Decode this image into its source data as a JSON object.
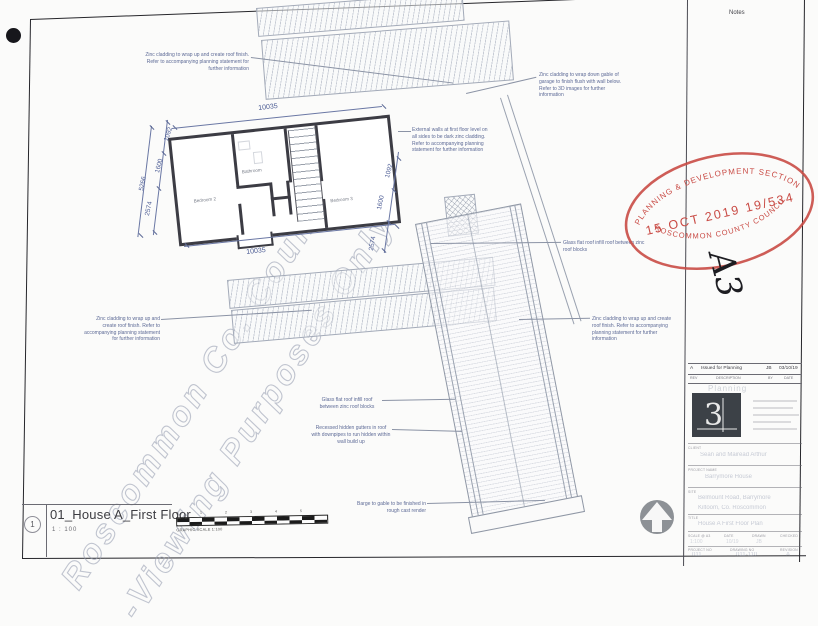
{
  "page": {
    "notes_label": "Notes",
    "size_mark": "A3"
  },
  "watermark": {
    "line1": "Roscommon Co. Council",
    "line2": "-Viewing Purposes Only!"
  },
  "stamp": {
    "top": "PLANNING & DEVELOPMENT SECTION",
    "middle": "15 OCT 2019  19/534",
    "bottom": "ROSCOMMON COUNTY COUNCIL",
    "color": "#c94b45"
  },
  "annotations": [
    {
      "text": "Zinc cladding to wrap up and create roof finish. Refer to accompanying planning statement for further information"
    },
    {
      "text": "Zinc cladding to wrap down gable of garage to finish flush with wall below. Refer to 3D images for further information"
    },
    {
      "text": "External walls at first floor level on all sides to be dark zinc cladding. Refer to accompanying planning statement for further information"
    },
    {
      "text": "Glass flat roof infill roof between zinc roof blocks"
    },
    {
      "text": "Zinc cladding to wrap up and create roof finish. Refer to accompanying planning statement for further information"
    },
    {
      "text": "Zinc cladding to wrap up and create roof finish. Refer to accompanying planning statement for further information"
    },
    {
      "text": "Glass flat roof infill roof between zinc roof blocks"
    },
    {
      "text": "Recessed hidden gutters in roof with downpipes to run hidden within wall build up"
    },
    {
      "text": "Barge to gable to be finished in rough cast render"
    }
  ],
  "plan": {
    "rooms": {
      "bathroom": "Bathroom",
      "bedroom2": "Bedroom 2",
      "bedroom3": "Bedroom 3"
    },
    "dims": {
      "top": "10035",
      "bottom": "10035",
      "left_overall": "5266",
      "left": [
        "1092",
        "1600",
        "2574"
      ],
      "right": [
        "1092",
        "1600",
        "2574"
      ]
    }
  },
  "scalebar": {
    "ticks": [
      "0",
      "1",
      "2",
      "3",
      "4",
      "5"
    ],
    "label": "GRAPHIC SCALE 1:100"
  },
  "titlebar": {
    "number": "1",
    "title": "01_House A_First Floor",
    "scale": "1 : 100"
  },
  "title_block": {
    "rev": {
      "rev": "A",
      "description": "Issued for Planning",
      "by": "JB",
      "date": "03/10/19"
    },
    "headers": {
      "rev": "REV",
      "description": "DESCRIPTION",
      "by": "BY",
      "date": "DATE"
    },
    "status": "Planning",
    "logo_glyph": "3",
    "client_label": "CLIENT",
    "client": "Sean and Mairead Arthur",
    "project_label": "PROJECT NAME",
    "project": "Barrymore House",
    "site_label": "SITE",
    "site1": "Belmount Road, Barrymore",
    "site2": "Kiltoom, Co. Roscommon",
    "title_label": "TITLE",
    "title": "House A First Floor Plan",
    "fields": [
      {
        "label": "SCALE @ A3",
        "value": "1:100"
      },
      {
        "label": "DATE",
        "value": "10/19"
      },
      {
        "label": "DRAWN",
        "value": "JB"
      },
      {
        "label": "CHECKED",
        "value": ""
      }
    ],
    "numbers": [
      {
        "label": "PROJECT NO",
        "value": "011"
      },
      {
        "label": "DRAWING NO",
        "value": "011-110"
      },
      {
        "label": "REVISION",
        "value": "A"
      }
    ]
  }
}
